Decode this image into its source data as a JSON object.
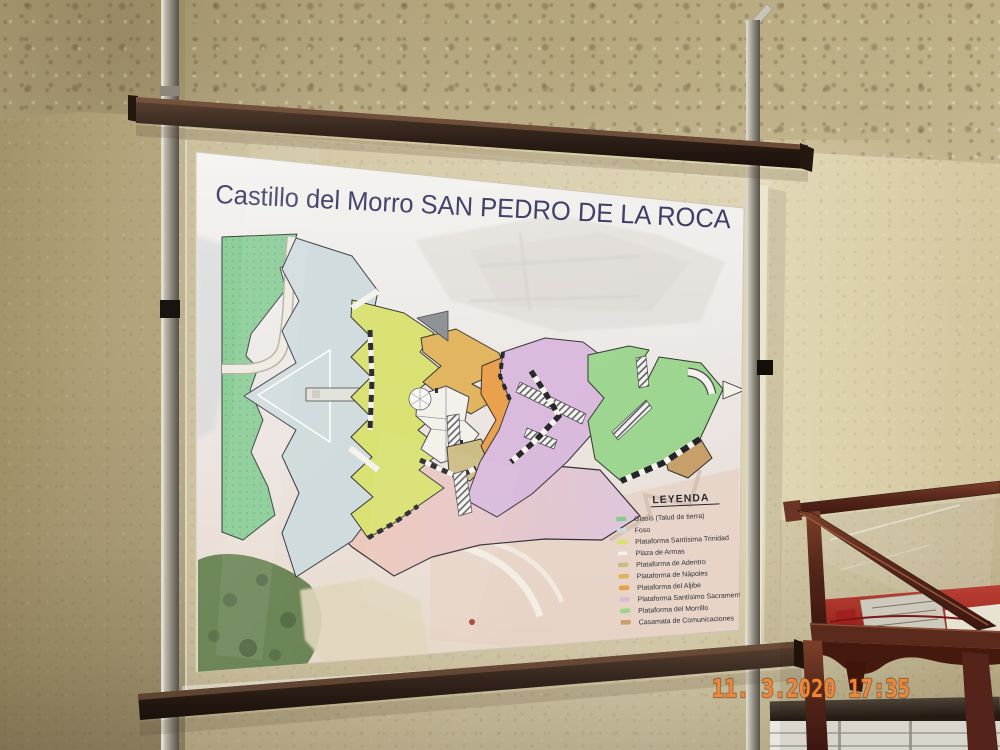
{
  "sign": {
    "title": "Castillo del Morro SAN PEDRO DE LA ROCA",
    "title_color": "#2f2c5a"
  },
  "legend": {
    "title": "LEYENDA",
    "items": [
      {
        "label": "Glasis (Talud de tierra)",
        "color": "#7ec88c"
      },
      {
        "label": "Foso",
        "color": "#ccd8da"
      },
      {
        "label": "Plataforma Santísima Trinidad",
        "color": "#d6de66"
      },
      {
        "label": "Plaza de Armas",
        "color": "#f2f0e8"
      },
      {
        "label": "Plataforma de Adentro",
        "color": "#c9b87b"
      },
      {
        "label": "Plataforma de Nápoles",
        "color": "#dfae52"
      },
      {
        "label": "Plataforma del Aljibe",
        "color": "#e8993f"
      },
      {
        "label": "Plataforma Santísimo Sacramento",
        "color": "#d7b5da"
      },
      {
        "label": "Plataforma del Morrillo",
        "color": "#97d389"
      },
      {
        "label": "Casamata de Comunicaciones",
        "color": "#c49a62"
      }
    ]
  },
  "plan": {
    "zones": {
      "glasis": "#7ec88c",
      "foso": "#ccd8da",
      "trinidad": "#d6de66",
      "plaza": "#f2f0e8",
      "adentro": "#c9b87b",
      "napoles": "#dfae52",
      "aljibe": "#e8993f",
      "sacramento": "#d7b5da",
      "morrillo": "#97d389",
      "casamata": "#c49a62",
      "esplanade_from": "#eec5ad",
      "esplanade_to": "#dcc3da"
    }
  },
  "camera_osd": {
    "timestamp": "11. 3.2020  17:35",
    "color": "#ee8737"
  }
}
